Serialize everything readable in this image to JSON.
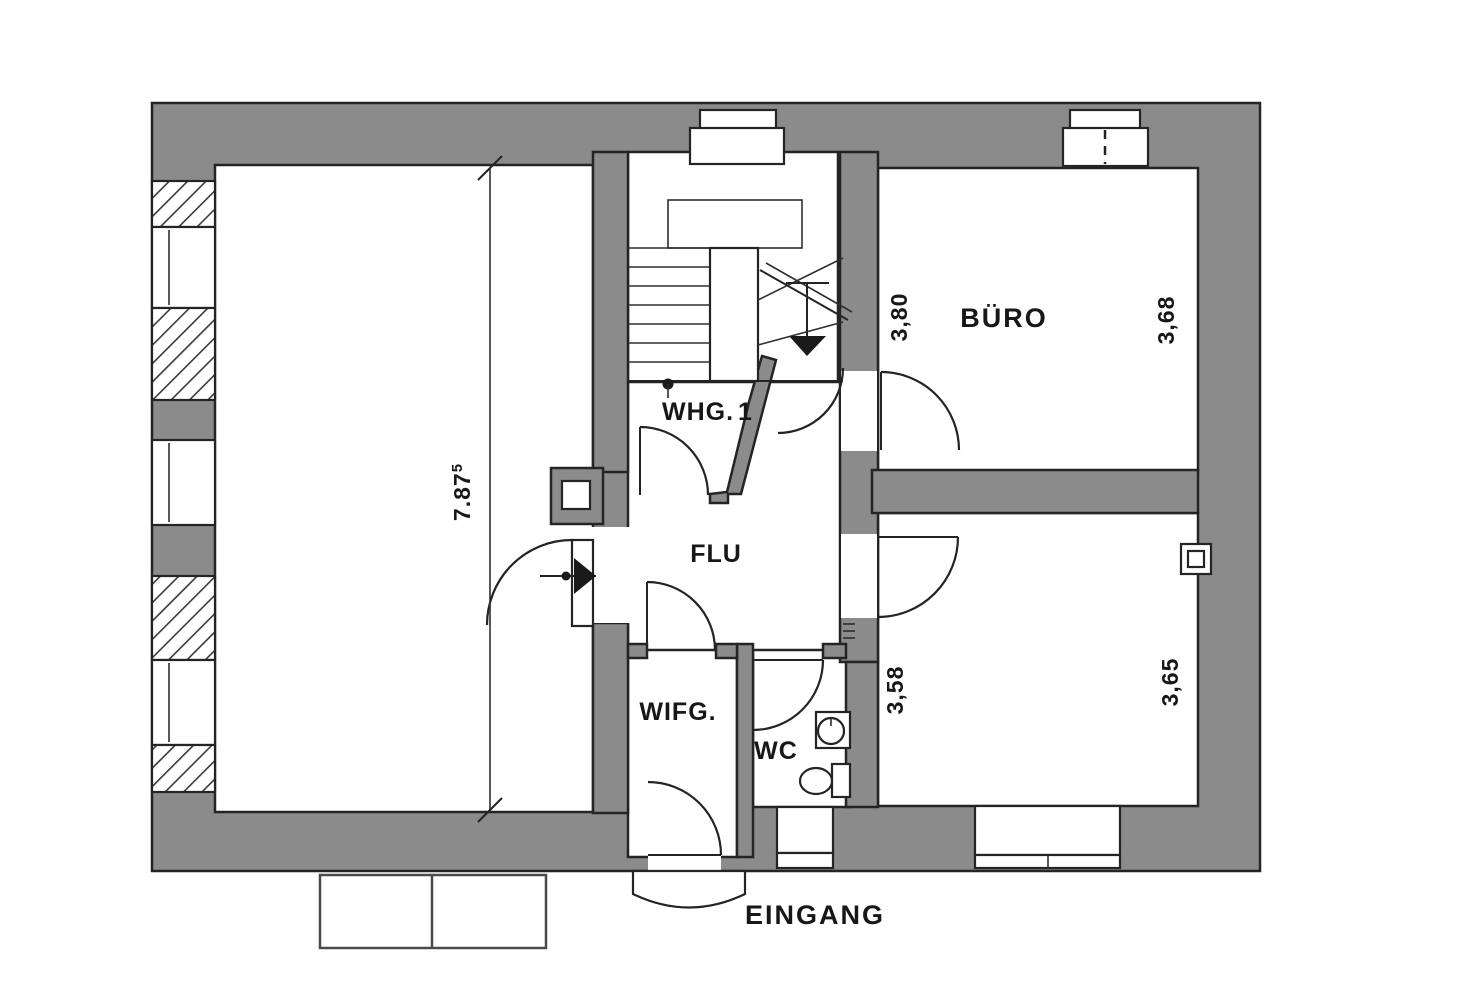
{
  "plan": {
    "type": "floor-plan",
    "colors": {
      "wall": "#8B8B8B",
      "line": "#242424",
      "paper": "#FFFFFF"
    },
    "rooms": {
      "whg1": {
        "label": "WHG.",
        "number": "1"
      },
      "flur": {
        "label": "FLU"
      },
      "windfang": {
        "label": "WIFG."
      },
      "wc": {
        "label": "WC"
      },
      "buero": {
        "label": "BÜRO"
      },
      "eingang": {
        "label": "EINGANG"
      }
    },
    "dimensions": {
      "left_room_depth": {
        "value": "7.87",
        "sup": "5"
      },
      "buero_width_left": "3,80",
      "buero_width_right": "3,68",
      "zimmer_width_left": "3,58",
      "zimmer_width_right": "3,65"
    }
  }
}
